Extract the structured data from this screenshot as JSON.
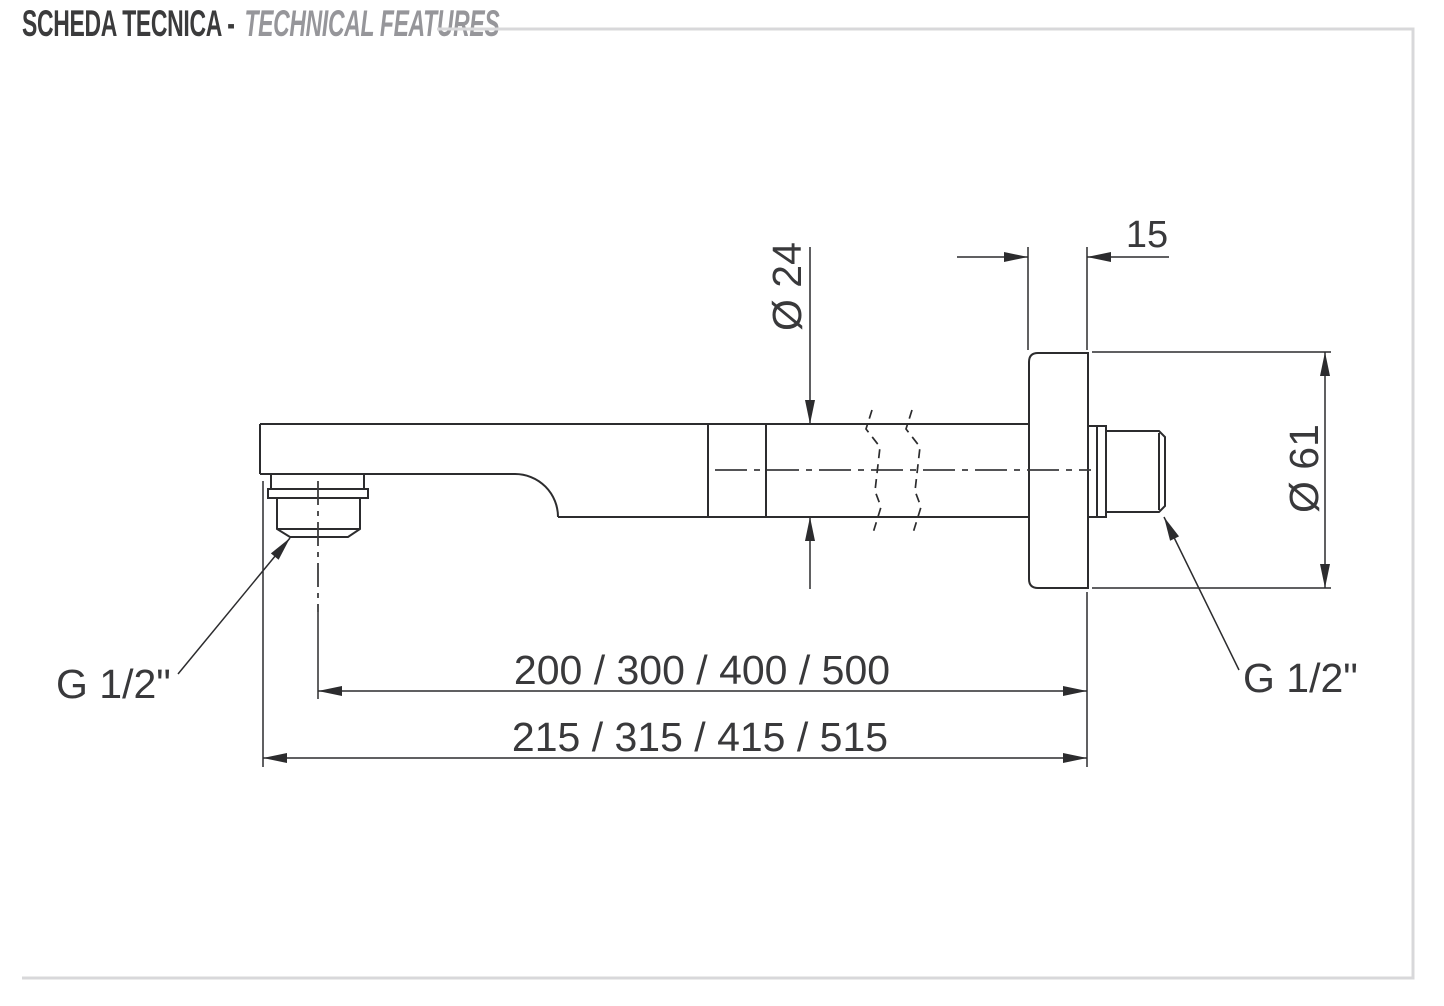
{
  "header": {
    "title_primary": "SCHEDA TECNICA -",
    "title_secondary": "TECHNICAL FEATURES"
  },
  "drawing": {
    "dimensions": {
      "plate_thickness": "15",
      "arm_diameter": "Ø 24",
      "flange_diameter": "Ø 61",
      "length_to_outlet_center": "200 / 300 / 400 / 500",
      "length_overall": "215 / 315 / 415 / 515",
      "outlet_thread": "G 1/2\"",
      "inlet_thread": "G 1/2\""
    },
    "colors": {
      "line": "#2c2c2e",
      "dimension_text": "#39393b",
      "title_primary": "#3b3b3c",
      "title_secondary": "#96969a",
      "frame": "#d8d8da"
    }
  }
}
